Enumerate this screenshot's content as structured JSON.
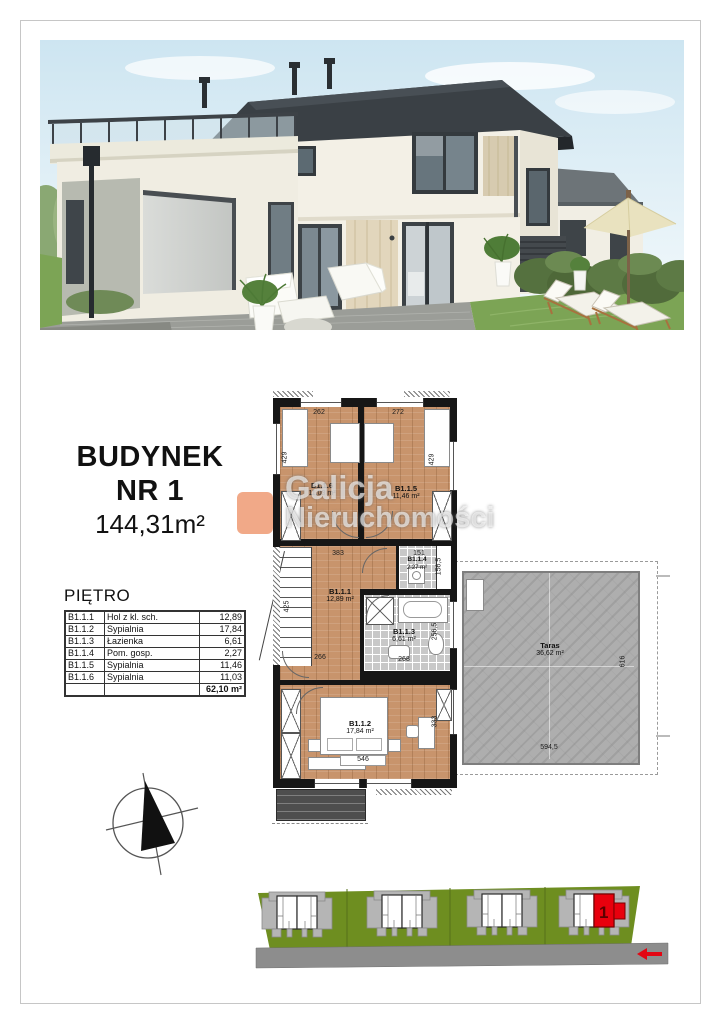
{
  "title_block": {
    "line1": "BUDYNEK",
    "line2": "NR 1",
    "area": "144,31m²"
  },
  "floor_table": {
    "heading": "PIĘTRO",
    "rows": [
      {
        "code": "B1.1.1",
        "name": "Hol z kl. sch.",
        "area": "12,89"
      },
      {
        "code": "B1.1.2",
        "name": "Sypialnia",
        "area": "17,84"
      },
      {
        "code": "B1.1.3",
        "name": "Łazienka",
        "area": "6,61"
      },
      {
        "code": "B1.1.4",
        "name": "Pom. gosp.",
        "area": "2,27"
      },
      {
        "code": "B1.1.5",
        "name": "Sypialnia",
        "area": "11,46"
      },
      {
        "code": "B1.1.6",
        "name": "Sypialnia",
        "area": "11,03"
      }
    ],
    "total_area": "62,10 m²"
  },
  "floor_plan": {
    "rooms": [
      {
        "id": "B1.1.1",
        "area": "12,89 m²"
      },
      {
        "id": "B1.1.2",
        "area": "17,84 m²"
      },
      {
        "id": "B1.1.3",
        "area": "6,61 m²"
      },
      {
        "id": "B1.1.4",
        "area": "2,27 m²"
      },
      {
        "id": "B1.1.5",
        "area": "11,46 m²"
      },
      {
        "id": "B1.1.6",
        "area": "11,03 m²"
      }
    ],
    "terrace": {
      "name": "Taras",
      "area": "36,62 m²"
    },
    "dims": {
      "top_left": "262",
      "top_right": "272",
      "left_upper": "429",
      "right_upper": "429",
      "hall_top": "383",
      "util_top": "151",
      "util_right": "156,5",
      "left_mid": "425",
      "hall_bottom": "266",
      "bath_bottom": "268",
      "bath_right": "256,5",
      "bedroom_bottom": "546",
      "bedroom_right": "333",
      "terrace_bottom": "594,5",
      "terrace_right": "616"
    }
  },
  "watermark": {
    "line1": "Galicja",
    "line2": "Nieruchomości"
  },
  "site_plan": {
    "unit_label": "1"
  },
  "colors": {
    "accent_red": "#e30613",
    "watermark_orange": "#e4540f",
    "site_green": "#6e8e20",
    "road_gray": "#8d8d8d",
    "wood": "#c8946c",
    "tile": "#c8c8c8",
    "wall": "#161616"
  }
}
